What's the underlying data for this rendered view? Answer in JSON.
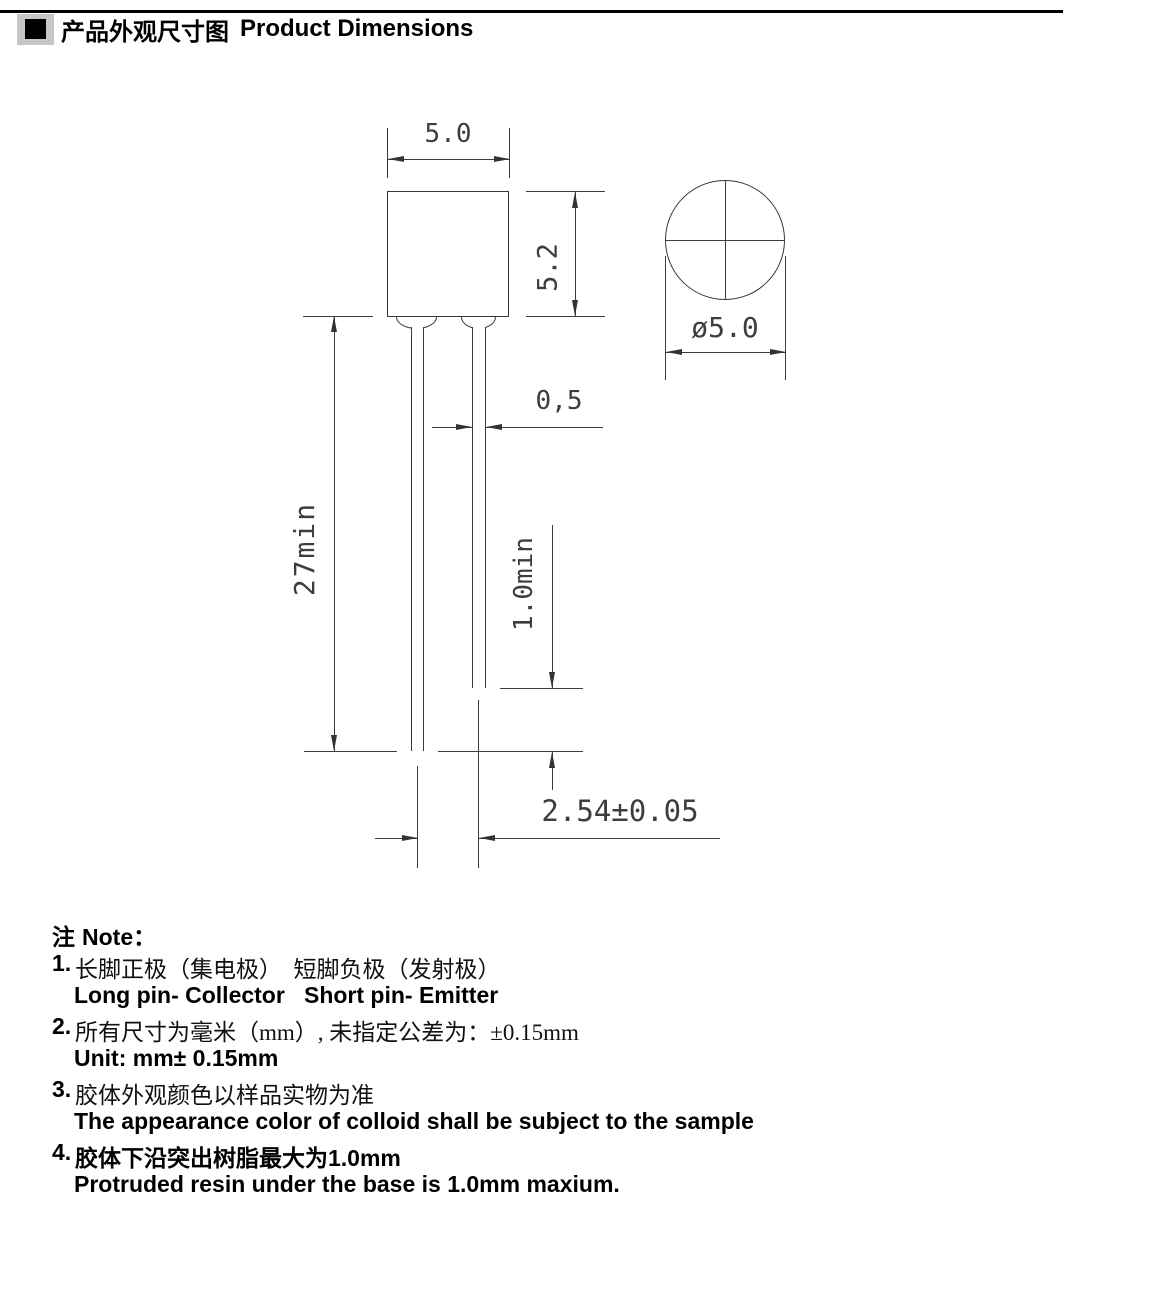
{
  "page": {
    "title_zh": "产品外观尺寸图",
    "title_en": "Product Dimensions"
  },
  "drawing": {
    "dims": {
      "body_width": "5.0",
      "body_height": "5.2",
      "lens_diameter": "ø5.0",
      "pin_thickness": "0,5",
      "long_pin_length": "27min",
      "pin_length_diff": "1.0min",
      "pin_pitch": "2.54±0.05"
    }
  },
  "notes": {
    "header_zh": "注",
    "header_en": "Note：",
    "items": [
      {
        "num": "1.",
        "zh": "长脚正极（集电极）　短脚负极（发射极）",
        "en": "Long pin- Collector   Short pin- Emitter"
      },
      {
        "num": "2.",
        "zh": "所有尺寸为毫米（mm）, 未指定公差为：±0.15mm",
        "en": "Unit: mm± 0.15mm"
      },
      {
        "num": "3.",
        "zh": "胶体外观颜色以样品实物为准",
        "en": "The appearance color of colloid shall be subject to the sample"
      },
      {
        "num": "4.",
        "zh": "胶体下沿突出树脂最大为1.0mm",
        "en": "Protruded resin under the base is 1.0mm maxium."
      }
    ]
  }
}
